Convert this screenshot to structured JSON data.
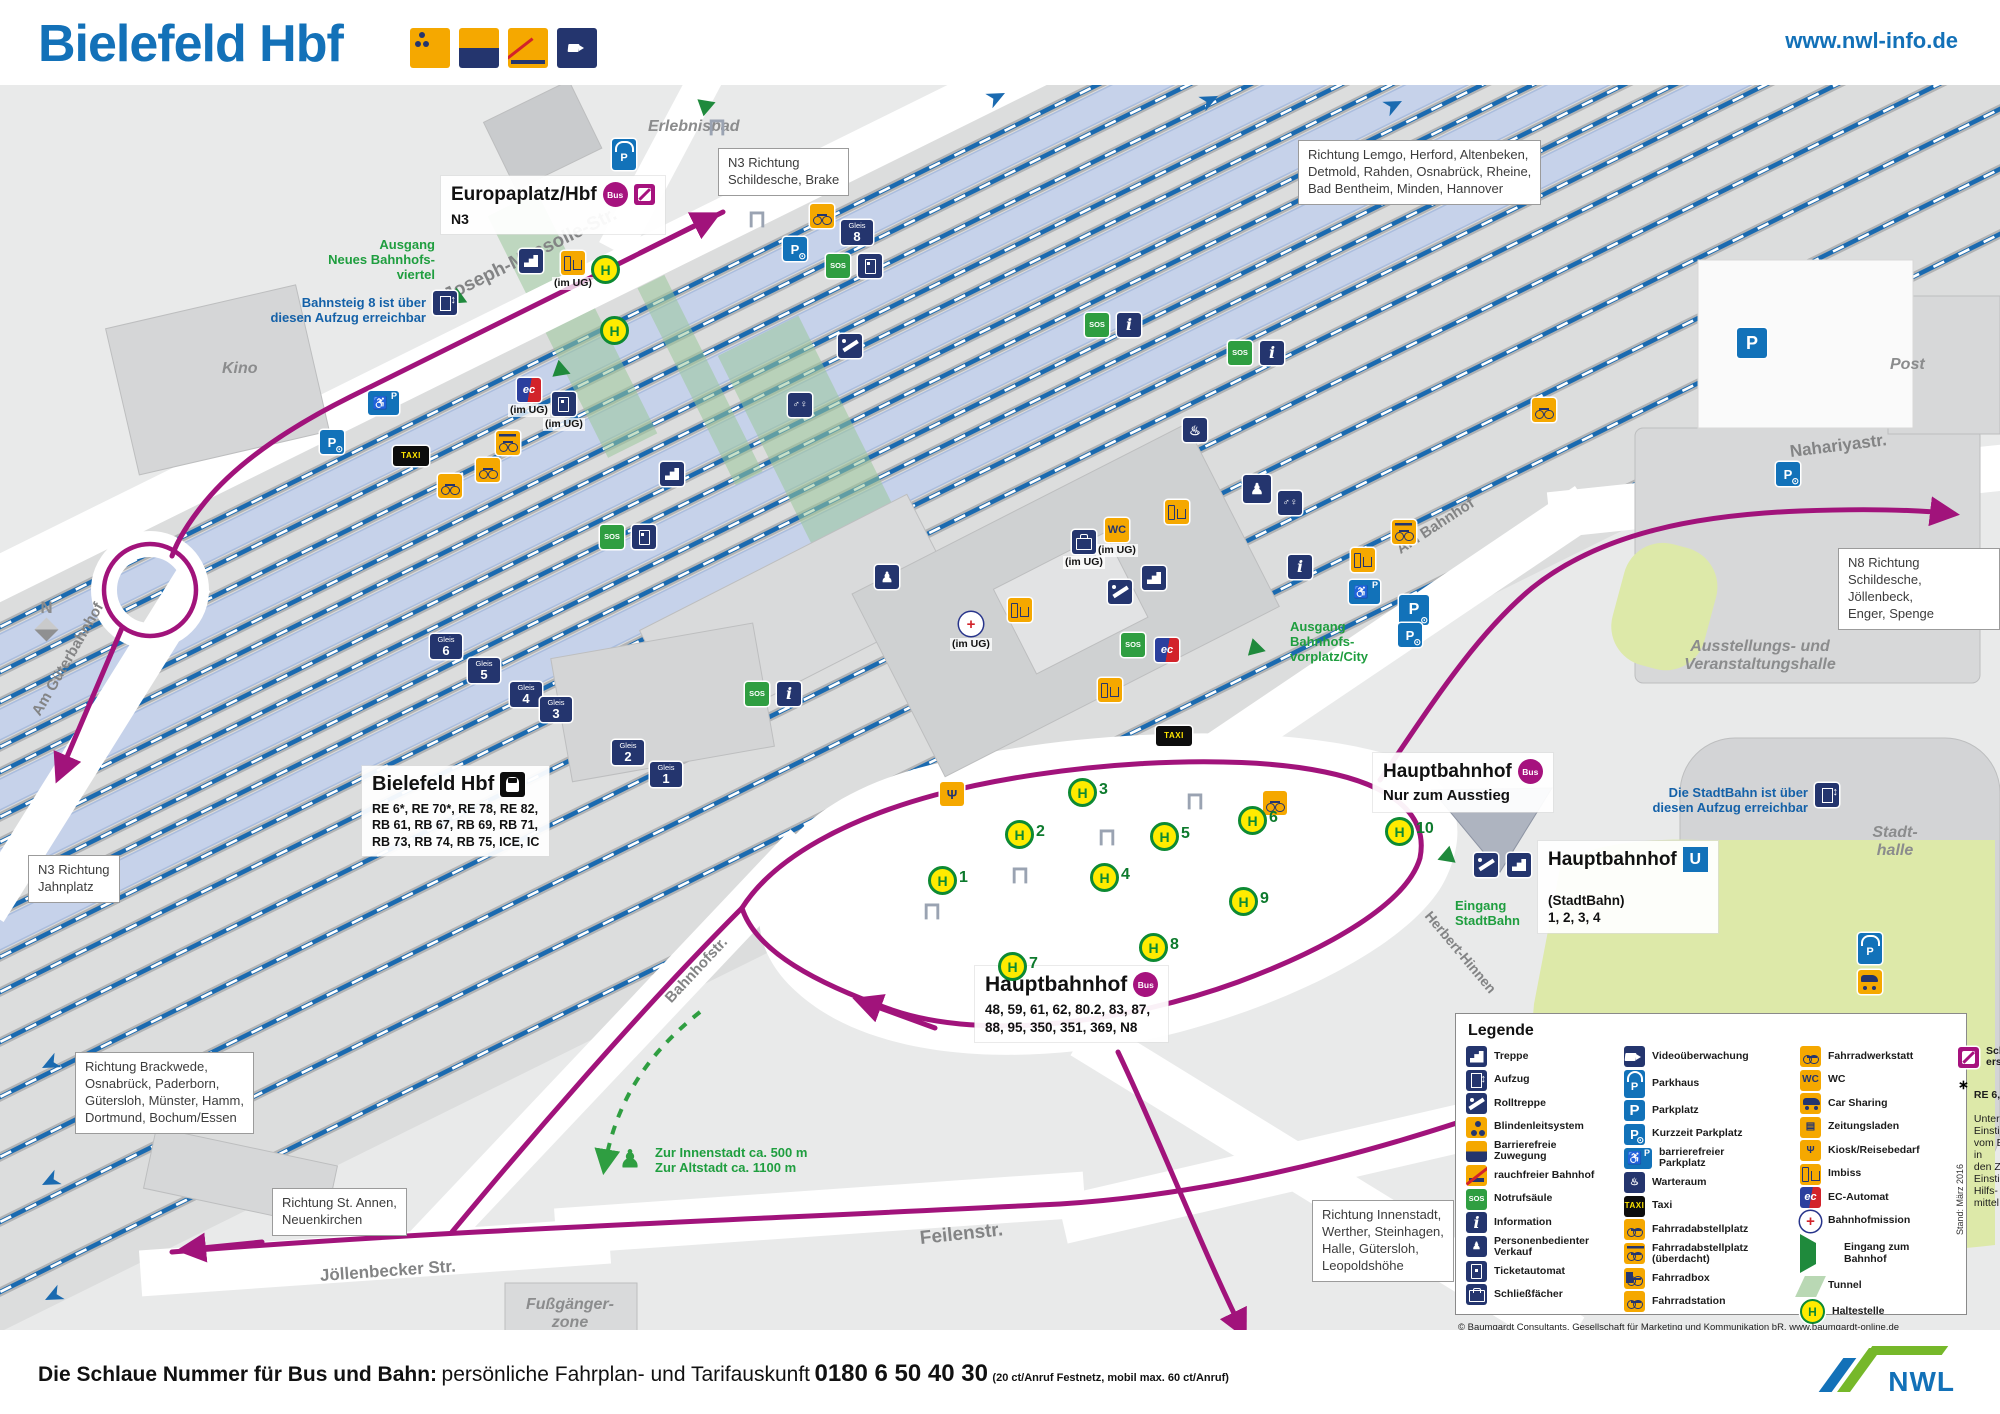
{
  "header": {
    "title": "Bielefeld Hbf",
    "website": "www.nwl-info.de",
    "icons": [
      {
        "n": "blindenleitsystem-icon",
        "c": "sh-blind"
      },
      {
        "n": "barrierefreie-zuwegung-icon",
        "c": "sh-split"
      },
      {
        "n": "rauchfreier-bahnhof-icon",
        "c": "sh-nosmoke"
      },
      {
        "n": "videoueberwachung-icon",
        "c": "navy sh-cam"
      }
    ]
  },
  "footer": {
    "lead_bold": "Die Schlaue Nummer für Bus und Bahn:",
    "lead_regular": "persönliche Fahrplan- und Tarifauskunft",
    "phone": "0180 6 50 40 30",
    "phone_note": "(20 ct/Anruf Festnetz, mobil max. 60 ct/Anruf)",
    "logo_text": "NWL"
  },
  "stations": {
    "europaplatz": {
      "title": "Europaplatz/Hbf",
      "bus_badge": "Bus",
      "line": "N3"
    },
    "bielefeld": {
      "title": "Bielefeld Hbf",
      "services": "RE 6*, RE 70*, RE 78, RE 82,\nRB 61, RB 67, RB 69, RB 71,\nRB 73, RB 74, RB 75, ICE, IC"
    },
    "hbf_bus": {
      "title": "Hauptbahnhof",
      "bus_badge": "Bus",
      "services": "48, 59, 61, 62, 80.2, 83, 87,\n88, 95, 350, 351, 369, N8"
    },
    "hbf_exit": {
      "title": "Hauptbahnhof",
      "bus_badge": "Bus",
      "note": "Nur zum Ausstieg"
    },
    "stadtbahn": {
      "title": "Hauptbahnhof",
      "u_badge": "U",
      "prefix": "(StadtBahn)",
      "lines": "1, 2, 3, 4"
    }
  },
  "map": {
    "direction_boxes": [
      {
        "t": "N3 Richtung\nSchildesche, Brake",
        "x": 718,
        "y": 148
      },
      {
        "t": "Richtung Lemgo, Herford, Altenbeken,\nDetmold, Rahden, Osnabrück, Rheine,\nBad Bentheim, Minden, Hannover",
        "x": 1298,
        "y": 140
      },
      {
        "t": "N8 Richtung\nSchildesche, Jöllenbeck,\nEnger, Spenge",
        "x": 1838,
        "y": 548
      },
      {
        "t": "N3 Richtung\nJahnplatz",
        "x": 28,
        "y": 855
      },
      {
        "t": "Richtung Brackwede,\nOsnabrück, Paderborn,\nGütersloh, Münster, Hamm,\nDortmund, Bochum/Essen",
        "x": 75,
        "y": 1052
      },
      {
        "t": "Richtung St. Annen,\nNeuenkirchen",
        "x": 272,
        "y": 1188
      },
      {
        "t": "Richtung Innenstadt,\nWerther, Steinhagen,\nHalle, Gütersloh,\nLeopoldshöhe",
        "x": 1312,
        "y": 1200
      }
    ],
    "green_notes": [
      {
        "t": "Ausgang\nNeues Bahnhofs-\nviertel",
        "x": 275,
        "y": 238,
        "a": "right",
        "w": 160
      },
      {
        "t": "Eingang\nStadtBahn",
        "x": 1455,
        "y": 899
      },
      {
        "t": "Ausgang\nBahnhofs-\nvorplatz/City",
        "x": 1290,
        "y": 620
      },
      {
        "t": "Zur Innenstadt ca. 500 m\nZur Altstadt ca. 1100 m",
        "x": 655,
        "y": 1146
      }
    ],
    "blue_notes": [
      {
        "t": "Bahnsteig 8 ist über\ndiesen Aufzug erreichbar",
        "x": 196,
        "y": 296,
        "w": 230
      },
      {
        "t": "Die StadtBahn ist über\ndiesen Aufzug erreichbar",
        "x": 1636,
        "y": 786,
        "w": 172
      }
    ],
    "area_labels": [
      {
        "t": "Erlebnisbad",
        "x": 648,
        "y": 118
      },
      {
        "t": "Kino",
        "x": 222,
        "y": 360
      },
      {
        "t": "Post",
        "x": 1890,
        "y": 356
      },
      {
        "t": "Ausstellungs- und\nVeranstaltungshalle",
        "x": 1660,
        "y": 638,
        "a": "center",
        "w": 200
      },
      {
        "t": "Stadt-\nhalle",
        "x": 1840,
        "y": 824,
        "a": "center",
        "w": 110
      },
      {
        "t": "Fußgänger-\nzone",
        "x": 505,
        "y": 1296,
        "a": "center",
        "w": 130
      }
    ],
    "streets": [
      {
        "t": "Joseph-Massolle-Str.",
        "x": 445,
        "y": 286,
        "r": -26,
        "s": 19
      },
      {
        "t": "Am Güterbahnhof",
        "x": 36,
        "y": 706,
        "r": -60,
        "s": 15
      },
      {
        "t": "Am Bahnhof",
        "x": 1398,
        "y": 542,
        "r": -33,
        "s": 15
      },
      {
        "t": "Nahariyastr.",
        "x": 1790,
        "y": 442,
        "r": -7,
        "s": 17
      },
      {
        "t": "Bahnhofstr.",
        "x": 668,
        "y": 992,
        "r": -47,
        "s": 15
      },
      {
        "t": "Jöllenbecker Str.",
        "x": 320,
        "y": 1266,
        "r": -4,
        "s": 17
      },
      {
        "t": "Feilenstr.",
        "x": 920,
        "y": 1228,
        "r": -6,
        "s": 19
      },
      {
        "t": "Herbert-Hinnen",
        "x": 1428,
        "y": 905,
        "r": 50,
        "s": 14
      }
    ],
    "gleis_badges": [
      {
        "n": "8",
        "x": 841,
        "y": 220
      },
      {
        "n": "6",
        "x": 430,
        "y": 634
      },
      {
        "n": "5",
        "x": 468,
        "y": 658
      },
      {
        "n": "4",
        "x": 510,
        "y": 682
      },
      {
        "n": "3",
        "x": 540,
        "y": 697
      },
      {
        "n": "2",
        "x": 612,
        "y": 740
      },
      {
        "n": "1",
        "x": 650,
        "y": 762
      }
    ],
    "stops": [
      {
        "n": "1",
        "x": 928,
        "y": 866
      },
      {
        "n": "2",
        "x": 1005,
        "y": 820
      },
      {
        "n": "3",
        "x": 1068,
        "y": 778
      },
      {
        "n": "4",
        "x": 1090,
        "y": 863
      },
      {
        "n": "5",
        "x": 1150,
        "y": 822
      },
      {
        "n": "6",
        "x": 1238,
        "y": 806
      },
      {
        "n": "7",
        "x": 998,
        "y": 952
      },
      {
        "n": "8",
        "x": 1139,
        "y": 933
      },
      {
        "n": "9",
        "x": 1229,
        "y": 887
      },
      {
        "n": "10",
        "x": 1385,
        "y": 817
      },
      {
        "n": "",
        "x": 591,
        "y": 255
      },
      {
        "n": "",
        "x": 600,
        "y": 316
      }
    ],
    "icons": [
      {
        "n": "parkhaus",
        "c": "blue sh-roof",
        "g": "P",
        "x": 612,
        "y": 139
      },
      {
        "n": "entrance-neues-viertel",
        "c": "sh-tri",
        "x": 452,
        "y": 290,
        "r": 25
      },
      {
        "n": "stairs",
        "c": "navy sh-stairs",
        "x": 519,
        "y": 249
      },
      {
        "n": "imbiss",
        "c": "orange sh-imb",
        "x": 552,
        "y": 251,
        "p": "(im UG)"
      },
      {
        "n": "kurzzeit-parkplatz",
        "c": "blue sh-kurz",
        "g": "P",
        "x": 783,
        "y": 237
      },
      {
        "n": "fahrrad-parkplatz",
        "c": "orange sh-bike",
        "x": 810,
        "y": 204
      },
      {
        "n": "notrufsaeule",
        "c": "green",
        "g": "SOS",
        "x": 826,
        "y": 254
      },
      {
        "n": "ticketautomat",
        "c": "navy sh-tick",
        "x": 858,
        "y": 254
      },
      {
        "n": "aufzug",
        "c": "navy sh-elev",
        "x": 433,
        "y": 291
      },
      {
        "n": "barrierefreier-parkplatz",
        "c": "blue sh-hand",
        "g": "♿",
        "x": 368,
        "y": 391
      },
      {
        "n": "kurzzeit-parkplatz",
        "c": "blue sh-kurz",
        "g": "P",
        "x": 320,
        "y": 430
      },
      {
        "n": "taxi",
        "c": "black",
        "g": "TAXI",
        "x": 393,
        "y": 446,
        "w": 36,
        "h": 20
      },
      {
        "n": "fahrrad-parkplatz",
        "c": "orange sh-bike roofed",
        "x": 496,
        "y": 431
      },
      {
        "n": "fahrrad-abstellplatz",
        "c": "orange sh-bike",
        "x": 476,
        "y": 458
      },
      {
        "n": "fahrrad-abstellplatz",
        "c": "orange sh-bike",
        "x": 438,
        "y": 474
      },
      {
        "n": "ec-automat",
        "c": "sh-ec",
        "g": "ec",
        "x": 508,
        "y": 378,
        "p": "(im UG)"
      },
      {
        "n": "ticketautomat",
        "c": "navy sh-tick",
        "x": 543,
        "y": 392,
        "p": "(im UG)"
      },
      {
        "n": "notrufsaeule",
        "c": "green",
        "g": "SOS",
        "x": 1085,
        "y": 313
      },
      {
        "n": "information",
        "c": "navy info-g",
        "g": "i",
        "x": 1117,
        "y": 313
      },
      {
        "n": "notrufsaeule",
        "c": "green",
        "g": "SOS",
        "x": 1228,
        "y": 341
      },
      {
        "n": "information",
        "c": "navy info-g",
        "g": "i",
        "x": 1260,
        "y": 341
      },
      {
        "n": "fahrradwerkstatt",
        "c": "orange sh-bike",
        "x": 1532,
        "y": 398
      },
      {
        "n": "toilets",
        "c": "navy",
        "g": "♂♀",
        "x": 788,
        "y": 393,
        "f": 10
      },
      {
        "n": "stairs",
        "c": "navy sh-stairs",
        "x": 660,
        "y": 462
      },
      {
        "n": "escalator",
        "c": "navy sh-esc",
        "x": 838,
        "y": 334
      },
      {
        "n": "notrufsaeule",
        "c": "green",
        "g": "SOS",
        "x": 600,
        "y": 525
      },
      {
        "n": "ticketautomat",
        "c": "navy sh-tick",
        "x": 632,
        "y": 525
      },
      {
        "n": "pedestrian",
        "c": "navy",
        "g": "♟",
        "x": 875,
        "y": 565,
        "f": 14
      },
      {
        "n": "wc",
        "c": "orange",
        "g": "WC",
        "x": 1096,
        "y": 518,
        "f": 11,
        "p": "(im UG)"
      },
      {
        "n": "escalator",
        "c": "navy sh-esc",
        "x": 1108,
        "y": 580
      },
      {
        "n": "stairs",
        "c": "navy sh-stairs",
        "x": 1142,
        "y": 566
      },
      {
        "n": "bahnhofmission",
        "c": "sh-mis",
        "g": "+",
        "x": 950,
        "y": 612,
        "p": "(im UG)"
      },
      {
        "n": "imbiss",
        "c": "orange sh-imb",
        "x": 1008,
        "y": 598
      },
      {
        "n": "schliessfaecher",
        "c": "navy sh-lock",
        "x": 1063,
        "y": 530,
        "p": "(im UG)"
      },
      {
        "n": "notrufsaeule",
        "c": "green",
        "g": "SOS",
        "x": 745,
        "y": 682
      },
      {
        "n": "information",
        "c": "navy info-g",
        "g": "i",
        "x": 777,
        "y": 682
      },
      {
        "n": "warteraum",
        "c": "navy",
        "g": "♨",
        "x": 1183,
        "y": 418,
        "f": 13
      },
      {
        "n": "personenbedienter-verkauf",
        "c": "navy",
        "g": "♟",
        "x": 1243,
        "y": 475,
        "f": 15,
        "s": 28
      },
      {
        "n": "toilets",
        "c": "navy",
        "g": "♂♀",
        "x": 1278,
        "y": 491,
        "f": 10
      },
      {
        "n": "information",
        "c": "navy info-g",
        "g": "i",
        "x": 1288,
        "y": 555
      },
      {
        "n": "imbiss",
        "c": "orange sh-imb",
        "x": 1165,
        "y": 500
      },
      {
        "n": "imbiss",
        "c": "orange sh-imb",
        "x": 1098,
        "y": 678
      },
      {
        "n": "ec-automat",
        "c": "sh-ec",
        "g": "ec",
        "x": 1155,
        "y": 638
      },
      {
        "n": "notrufsaeule",
        "c": "green",
        "g": "SOS",
        "x": 1121,
        "y": 633
      },
      {
        "n": "taxi",
        "c": "black",
        "g": "TAXI",
        "x": 1156,
        "y": 726,
        "w": 36,
        "h": 20
      },
      {
        "n": "fahrrad-parkplatz",
        "c": "orange sh-bike roofed",
        "x": 1392,
        "y": 520
      },
      {
        "n": "imbiss",
        "c": "orange sh-imb",
        "x": 1351,
        "y": 548
      },
      {
        "n": "barrierefreier-parkplatz",
        "c": "blue sh-hand",
        "g": "♿",
        "x": 1349,
        "y": 580
      },
      {
        "n": "kurzzeit-parkplatz",
        "c": "blue sh-kurz",
        "g": "P",
        "x": 1399,
        "y": 595,
        "s": 30,
        "f": 16
      },
      {
        "n": "kiosk",
        "c": "orange",
        "g": "Ψ",
        "x": 940,
        "y": 782,
        "f": 13
      },
      {
        "n": "escalator",
        "c": "navy sh-esc",
        "x": 1474,
        "y": 853
      },
      {
        "n": "stairs",
        "c": "navy sh-stairs",
        "x": 1507,
        "y": 853
      },
      {
        "n": "entrance-stadtbahn",
        "c": "sh-tri",
        "x": 1437,
        "y": 848,
        "r": 160
      },
      {
        "n": "entrance-vorplatz",
        "c": "sh-tri",
        "x": 1250,
        "y": 640,
        "r": 15
      },
      {
        "n": "entrance-bahnhofsviertel",
        "c": "sh-tri",
        "x": 555,
        "y": 362,
        "r": 20
      },
      {
        "n": "entrance-erlebnisbad",
        "c": "sh-tri",
        "x": 700,
        "y": 96,
        "r": -20
      },
      {
        "n": "aufzug",
        "c": "navy sh-elev",
        "x": 1815,
        "y": 783
      },
      {
        "n": "parkplatz",
        "c": "blue",
        "g": "P",
        "x": 1737,
        "y": 328,
        "s": 30,
        "f": 18
      },
      {
        "n": "parkhaus",
        "c": "blue sh-roof",
        "g": "P",
        "x": 1858,
        "y": 933
      },
      {
        "n": "carsharing",
        "c": "orange sh-car",
        "x": 1858,
        "y": 970
      },
      {
        "n": "kurzzeit-parkplatz",
        "c": "blue sh-kurz",
        "g": "P",
        "x": 1776,
        "y": 462
      },
      {
        "n": "kurzzeit-parkplatz",
        "c": "blue sh-kurz",
        "g": "P",
        "x": 1398,
        "y": 623
      },
      {
        "n": "fahrrad-parkplatz",
        "c": "orange sh-bike",
        "x": 1263,
        "y": 791
      },
      {
        "n": "pedestrian-walk",
        "c": "greenfig",
        "g": "♟",
        "x": 618,
        "y": 1148,
        "f": 24
      },
      {
        "n": "shelter",
        "c": "shelter",
        "g": "⊓",
        "x": 1183,
        "y": 790,
        "f": 24
      },
      {
        "n": "shelter",
        "c": "shelter",
        "g": "⊓",
        "x": 1095,
        "y": 826,
        "f": 24
      },
      {
        "n": "shelter",
        "c": "shelter",
        "g": "⊓",
        "x": 1008,
        "y": 864,
        "f": 24
      },
      {
        "n": "shelter",
        "c": "shelter",
        "g": "⊓",
        "x": 920,
        "y": 900,
        "f": 24
      },
      {
        "n": "shelter",
        "c": "shelter",
        "g": "⊓",
        "x": 705,
        "y": 116,
        "f": 24
      },
      {
        "n": "shelter",
        "c": "shelter",
        "g": "⊓",
        "x": 745,
        "y": 208,
        "f": 24
      }
    ]
  },
  "legend": {
    "title": "Legende",
    "columns": [
      [
        {
          "i": "navy sh-stairs",
          "n": "treppe-icon",
          "l": "Treppe"
        },
        {
          "i": "navy sh-elev",
          "n": "aufzug-icon",
          "l": "Aufzug"
        },
        {
          "i": "navy sh-esc",
          "n": "rolltreppe-icon",
          "l": "Rolltreppe"
        },
        {
          "i": "sh-blind",
          "n": "blindenleitsystem-icon",
          "l": "Blindenleitsystem"
        },
        {
          "i": "sh-split",
          "n": "barrierefreie-zuwegung-icon",
          "l": "Barrierefreie\nZuwegung"
        },
        {
          "i": "sh-nosmoke",
          "n": "rauchfreier-bahnhof-icon",
          "l": "rauchfreier Bahnhof"
        },
        {
          "i": "green",
          "g": "SOS",
          "n": "notrufsaeule-icon",
          "l": "Notrufsäule"
        },
        {
          "i": "navy info-g",
          "g": "i",
          "n": "information-icon",
          "l": "Information"
        },
        {
          "i": "navy",
          "g": "♟",
          "n": "personenbedienter-verkauf-icon",
          "l": "Personenbedienter\nVerkauf"
        },
        {
          "i": "navy sh-tick",
          "n": "ticketautomat-icon",
          "l": "Ticketautomat"
        },
        {
          "i": "navy sh-lock",
          "n": "schliessfaecher-icon",
          "l": "Schließfächer"
        }
      ],
      [
        {
          "i": "navy sh-cam",
          "n": "videoueberwachung-icon",
          "l": "Videoüberwachung"
        },
        {
          "i": "blue sh-roof",
          "g": "P",
          "n": "parkhaus-icon",
          "l": "Parkhaus"
        },
        {
          "i": "blue",
          "g": "P",
          "n": "parkplatz-icon",
          "l": "Parkplatz"
        },
        {
          "i": "blue sh-kurz",
          "g": "P",
          "n": "kurzzeit-parkplatz-icon",
          "l": "Kurzzeit Parkplatz"
        },
        {
          "i": "blue sh-hand",
          "g": "♿",
          "n": "barrierefreier-parkplatz-icon",
          "l": "barrierefreier\nParkplatz"
        },
        {
          "i": "navy",
          "g": "♨",
          "n": "warteraum-icon",
          "l": "Warteraum"
        },
        {
          "i": "black",
          "g": "TAXI",
          "n": "taxi-icon",
          "l": "Taxi"
        },
        {
          "i": "orange sh-bike",
          "n": "fahrradabstellplatz-icon",
          "l": "Fahrradabstellplatz"
        },
        {
          "i": "orange sh-bike roofed",
          "n": "fahrradabstellplatz-ueberdacht-icon",
          "l": "Fahrradabstellplatz\n(überdacht)"
        },
        {
          "i": "orange sh-bike boxed",
          "n": "fahrradbox-icon",
          "l": "Fahrradbox"
        },
        {
          "i": "orange sh-bike",
          "n": "fahrradstation-icon",
          "l": "Fahrradstation"
        }
      ],
      [
        {
          "i": "orange sh-bike",
          "n": "fahrradwerkstatt-icon",
          "l": "Fahrradwerkstatt"
        },
        {
          "i": "orange",
          "g": "WC",
          "n": "wc-icon",
          "l": "WC"
        },
        {
          "i": "orange sh-car",
          "n": "car-sharing-icon",
          "l": "Car Sharing"
        },
        {
          "i": "orange",
          "g": "▤",
          "n": "zeitungsladen-icon",
          "l": "Zeitungsladen"
        },
        {
          "i": "orange",
          "g": "Ψ",
          "n": "kiosk-icon",
          "l": "Kiosk/Reisebedarf"
        },
        {
          "i": "orange sh-imb",
          "n": "imbiss-icon",
          "l": "Imbiss"
        },
        {
          "i": "sh-ec",
          "g": "ec",
          "n": "ec-automat-icon",
          "l": "EC-Automat"
        },
        {
          "i": "sh-mis",
          "g": "+",
          "n": "bahnhofmission-icon",
          "l": "Bahnhofmission"
        },
        {
          "i": "sh-tri",
          "n": "eingang-zum-bahnhof-icon",
          "l": "Eingang zum\nBahnhof"
        },
        {
          "i": "sh-tun",
          "n": "tunnel-icon",
          "l": "Tunnel"
        },
        {
          "i": "stop-mini",
          "g": "H",
          "n": "haltestelle-icon",
          "l": "Haltestelle"
        }
      ]
    ],
    "sev_label": "Schienen-\nersatzverkehr",
    "star": "∗",
    "note_title": "RE 6, RE 70:",
    "note_text": "Unterschiedliche\nEinstiegshöhen\nvom Bahnsteig in\nden Zug.\nEinstieg mit Hilfs-\nmittel möglich.",
    "stand": "Stand: März 2016",
    "copyright": "© Baumgardt Consultants, Gesellschaft für Marketing und Kommunikation bR, www.baumgardt-online.de"
  }
}
